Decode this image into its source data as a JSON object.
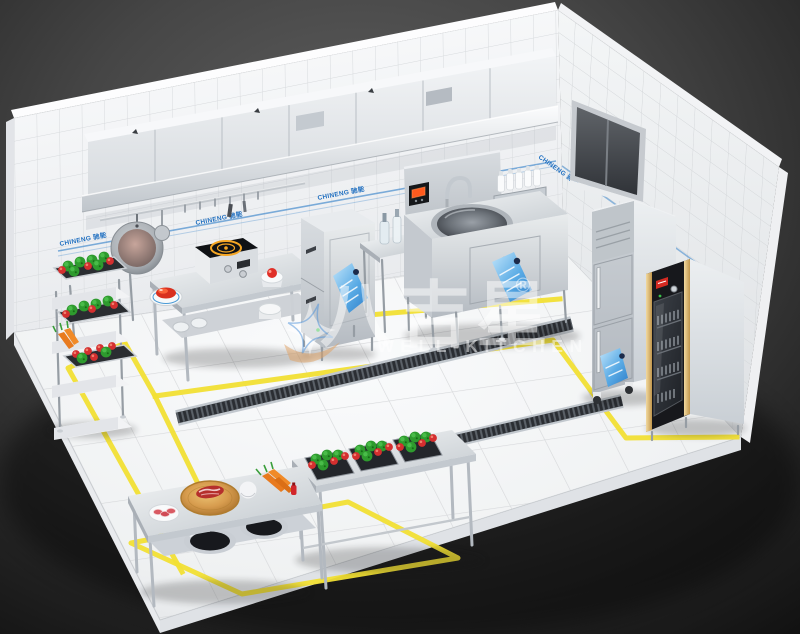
{
  "scene": {
    "label": "3D isometric commercial kitchen equipment layout render"
  },
  "watermark": {
    "brand": "八吉星",
    "registered": "®",
    "subtitle": "WELL-KITCHEN"
  },
  "wall": {
    "brand_label": "CHINENG 驰能"
  },
  "colors": {
    "background": "#2a2a2a",
    "tile_white": "#f7f8f9",
    "stainless": "#d6dadf",
    "marking_yellow": "#f1df34",
    "brand_blue": "#1f6fc0",
    "sticker_blue": "#3f9be0",
    "vegetable_green": "#2f9e2f",
    "vegetable_red": "#d83030",
    "induction_ring_orange": "#f5a623",
    "control_display_red": "#ff5a1e",
    "gold_trim": "#d8b36a",
    "wood_board": "#d79c4e"
  }
}
